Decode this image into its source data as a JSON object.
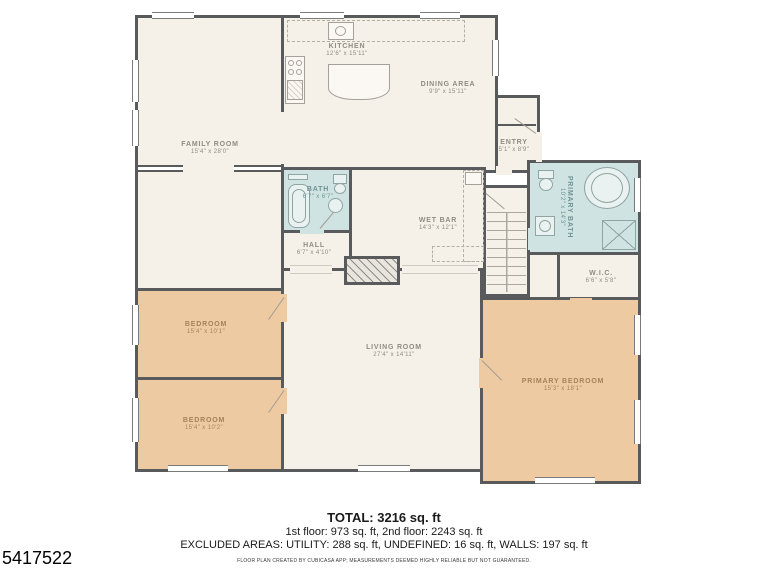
{
  "listing_id": "5417522",
  "summary": {
    "total": "TOTAL: 3216 sq. ft",
    "floors": "1st floor: 973 sq. ft, 2nd floor: 2243 sq. ft",
    "excluded_areas": "EXCLUDED AREAS: UTILITY: 288 sq. ft, UNDEFINED: 16 sq. ft, WALLS: 197 sq. ft",
    "disclaimer": "FLOOR PLAN CREATED BY CUBICASA APP; MEASUREMENTS DEEMED HIGHLY RELIABLE BUT NOT GUARANTEED."
  },
  "rooms": {
    "family_room": {
      "name": "FAMILY ROOM",
      "dims": "15'4\" x 28'0\""
    },
    "kitchen": {
      "name": "KITCHEN",
      "dims": "12'6\" x 15'11\""
    },
    "dining_area": {
      "name": "DINING AREA",
      "dims": "9'9\" x 15'11\""
    },
    "entry": {
      "name": "ENTRY",
      "dims": "5'1\" x 8'9\""
    },
    "bath": {
      "name": "BATH",
      "dims": "6'7\" x 6'7\""
    },
    "hall": {
      "name": "HALL",
      "dims": "6'7\" x 4'10\""
    },
    "wet_bar": {
      "name": "WET BAR",
      "dims": "14'3\" x 12'1\""
    },
    "primary_bath": {
      "name": "PRIMARY BATH",
      "dims": "10'2\" x 14'3\""
    },
    "wic": {
      "name": "W.I.C.",
      "dims": "6'6\" x 5'8\""
    },
    "bedroom_1": {
      "name": "BEDROOM",
      "dims": "15'4\" x 10'1\""
    },
    "bedroom_2": {
      "name": "BEDROOM",
      "dims": "15'4\" x 10'2\""
    },
    "living_room": {
      "name": "LIVING ROOM",
      "dims": "27'4\" x 14'11\""
    },
    "primary_bedroom": {
      "name": "PRIMARY BEDROOM",
      "dims": "15'3\" x 18'1\""
    }
  },
  "colors": {
    "wall": "#595a5c",
    "floor": "#f5f0e8",
    "bedroom_floor": "#eecaa2",
    "bath_floor": "#cfe3e2"
  }
}
